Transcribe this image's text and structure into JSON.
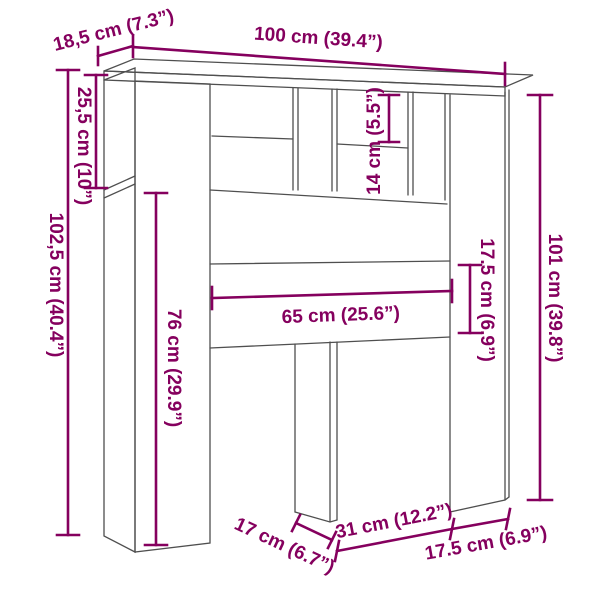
{
  "colors": {
    "dimension_accent": "#85005e",
    "outline_gray": "#4f4f4f",
    "background": "#ffffff"
  },
  "diagram": {
    "type": "furniture-dimension-diagram",
    "labels": {
      "depth": "18,5 cm (7.3”)",
      "width": "100 cm (39.4”)",
      "side_opening_height": "25,5 cm (10”)",
      "total_height": "102,5 cm (40.4”)",
      "left_panel_height": "76 cm (29.9”)",
      "shelf_opening_height": "14 cm (5.5”)",
      "inner_width": "65 cm (25.6”)",
      "panel_height": "17.5 cm (6.9”)",
      "right_height": "101 cm (39.8”)",
      "leg_depth": "17 cm (6.7”)",
      "leg_spacing": "31 cm (12.2”)",
      "right_panel_width": "17.5 cm (6.9”)"
    }
  }
}
